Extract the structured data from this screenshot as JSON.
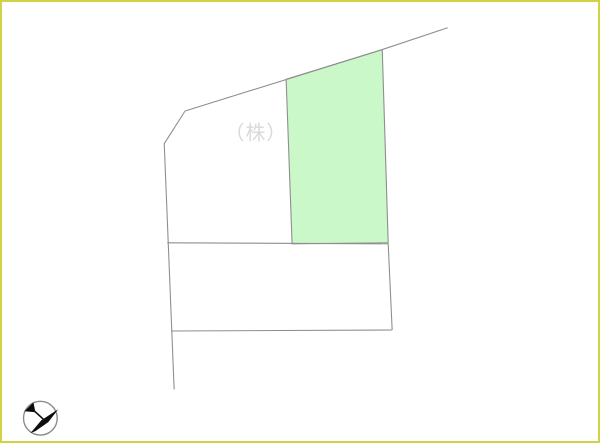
{
  "scene": {
    "background": "#ffffff",
    "border_color": "#d2d246",
    "line_color": "#8e8e8e"
  },
  "watermark": {
    "text": "（株）ベ",
    "color": "#d9d9d9",
    "font_size": "20"
  },
  "parcels": {
    "highlighted_lot": {
      "fill": "#cbf8c8",
      "stroke": "#8e8e8e",
      "points": "286,78 383,48 389,243 292,244"
    },
    "boundary_lines": [
      {
        "name": "road-edge-top",
        "points": "184,110 383,48 449,26"
      },
      {
        "name": "west-boundary",
        "points": "184,110 163,143 173,391"
      },
      {
        "name": "middle-divider",
        "points": "166,243 389,244"
      },
      {
        "name": "lower-lot-east-edge",
        "points": "389,244 393,331"
      },
      {
        "name": "lower-lot-south-edge",
        "points": "170,332 393,331"
      }
    ]
  },
  "compass": {
    "circle_color": "#8a8a8a",
    "needle_color": "#0d0d0d",
    "needle_body": "M10,35 L21,22 L38,11 L28,24 L15,33 Z",
    "needle_shaft": "M11,10 L23,21",
    "needle_arrow": "4,13 13,4 15,14"
  }
}
